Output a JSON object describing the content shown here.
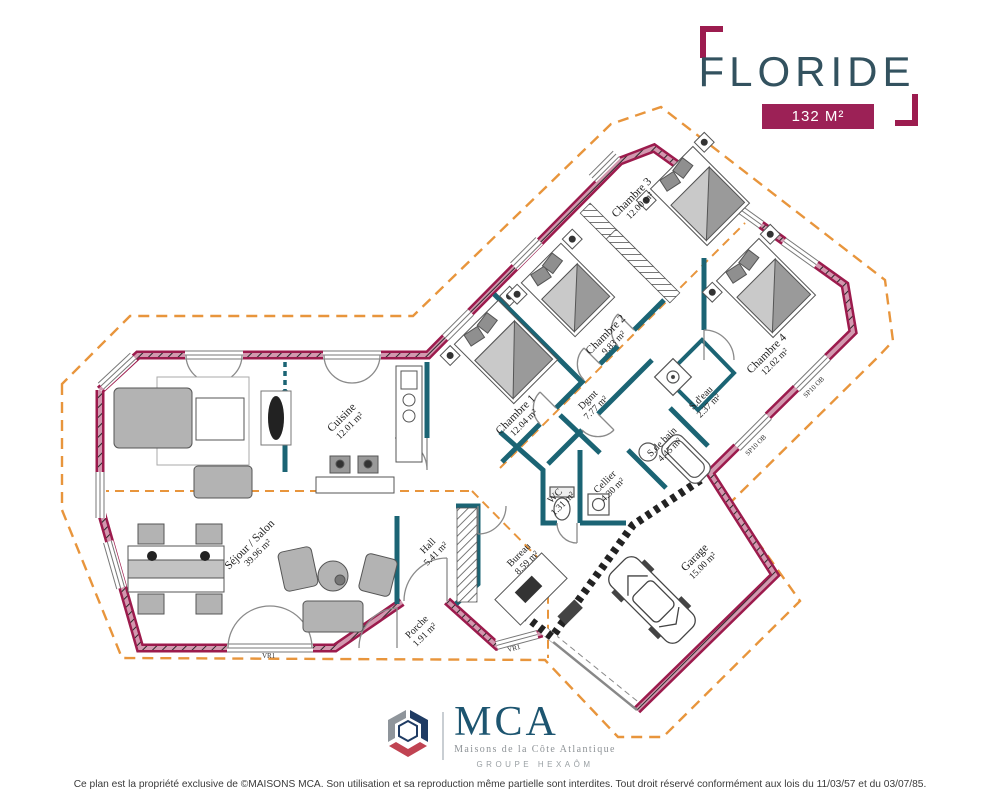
{
  "header": {
    "title": "FLORIDE",
    "area_badge": "132 M²"
  },
  "rooms": [
    {
      "id": "sejour",
      "name": "Séjour / Salon",
      "area": "39.96 m²"
    },
    {
      "id": "cuisine",
      "name": "Cuisine",
      "area": "12.01 m²"
    },
    {
      "id": "hall",
      "name": "Hall",
      "area": "5.41 m²"
    },
    {
      "id": "porche",
      "name": "Porche",
      "area": "1.91 m²"
    },
    {
      "id": "chambre1",
      "name": "Chambre 1",
      "area": "12.04 m²"
    },
    {
      "id": "chambre2",
      "name": "Chambre 2",
      "area": "9.83 m²"
    },
    {
      "id": "chambre3",
      "name": "Chambre 3",
      "area": "12.00 m²"
    },
    {
      "id": "chambre4",
      "name": "Chambre 4",
      "area": "12.02 m²"
    },
    {
      "id": "dgmt",
      "name": "Dgmt",
      "area": "7.77 m²"
    },
    {
      "id": "sdebain",
      "name": "S.de bain",
      "area": "4.45 m²"
    },
    {
      "id": "sdeau",
      "name": "S.d'eau",
      "area": "2.37 m²"
    },
    {
      "id": "wc",
      "name": "WC",
      "area": "1.31 m²"
    },
    {
      "id": "cellier",
      "name": "Cellier",
      "area": "4.30 m²"
    },
    {
      "id": "bureau",
      "name": "Bureau",
      "area": "8.59 m²"
    },
    {
      "id": "garage",
      "name": "Garage",
      "area": "15.00 m²"
    }
  ],
  "window_labels": {
    "vr1": "VR1",
    "sp10": "SP10 OB"
  },
  "footer": {
    "logo_text": "MCA",
    "logo_subtitle": "Maisons de la Côte Atlantique",
    "logo_group": "GROUPE HEXAÔM",
    "copyright": "Ce plan est la propriété exclusive de ©MAISONS MCA. Son utilisation et sa reproduction même partielle sont interdites. Tout droit réservé conformément aux lois du 11/03/57 et du 03/07/85."
  },
  "colors": {
    "exterior_wall": "#9c1b4d",
    "interior_wall": "#1b6474",
    "roof_dash": "#e8953c",
    "accent": "#9c2156",
    "title": "#33525f"
  }
}
